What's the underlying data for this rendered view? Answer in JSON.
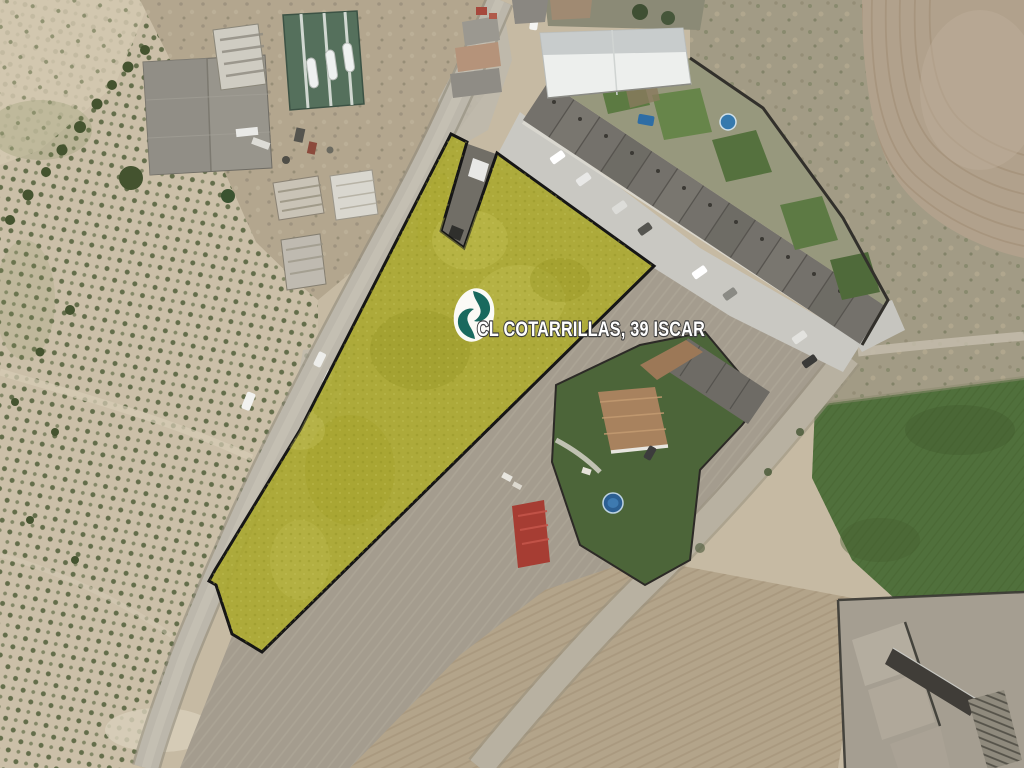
{
  "image": {
    "kind": "aerial-satellite-photo",
    "subject": "highlighted building plot with farm fields, road and townhouse row"
  },
  "watermark": {
    "address_label": "CL COTARRILLAS, 39 ISCAR",
    "logo": "estate-agency-logo",
    "colors": {
      "parcel_fill": "#aaa831",
      "parcel_border": "#161616",
      "logo_glyph": "#19695e",
      "logo_background": "#fdfdfc",
      "label_text": "#ffffff",
      "label_outline": "#3d3d3d"
    }
  }
}
